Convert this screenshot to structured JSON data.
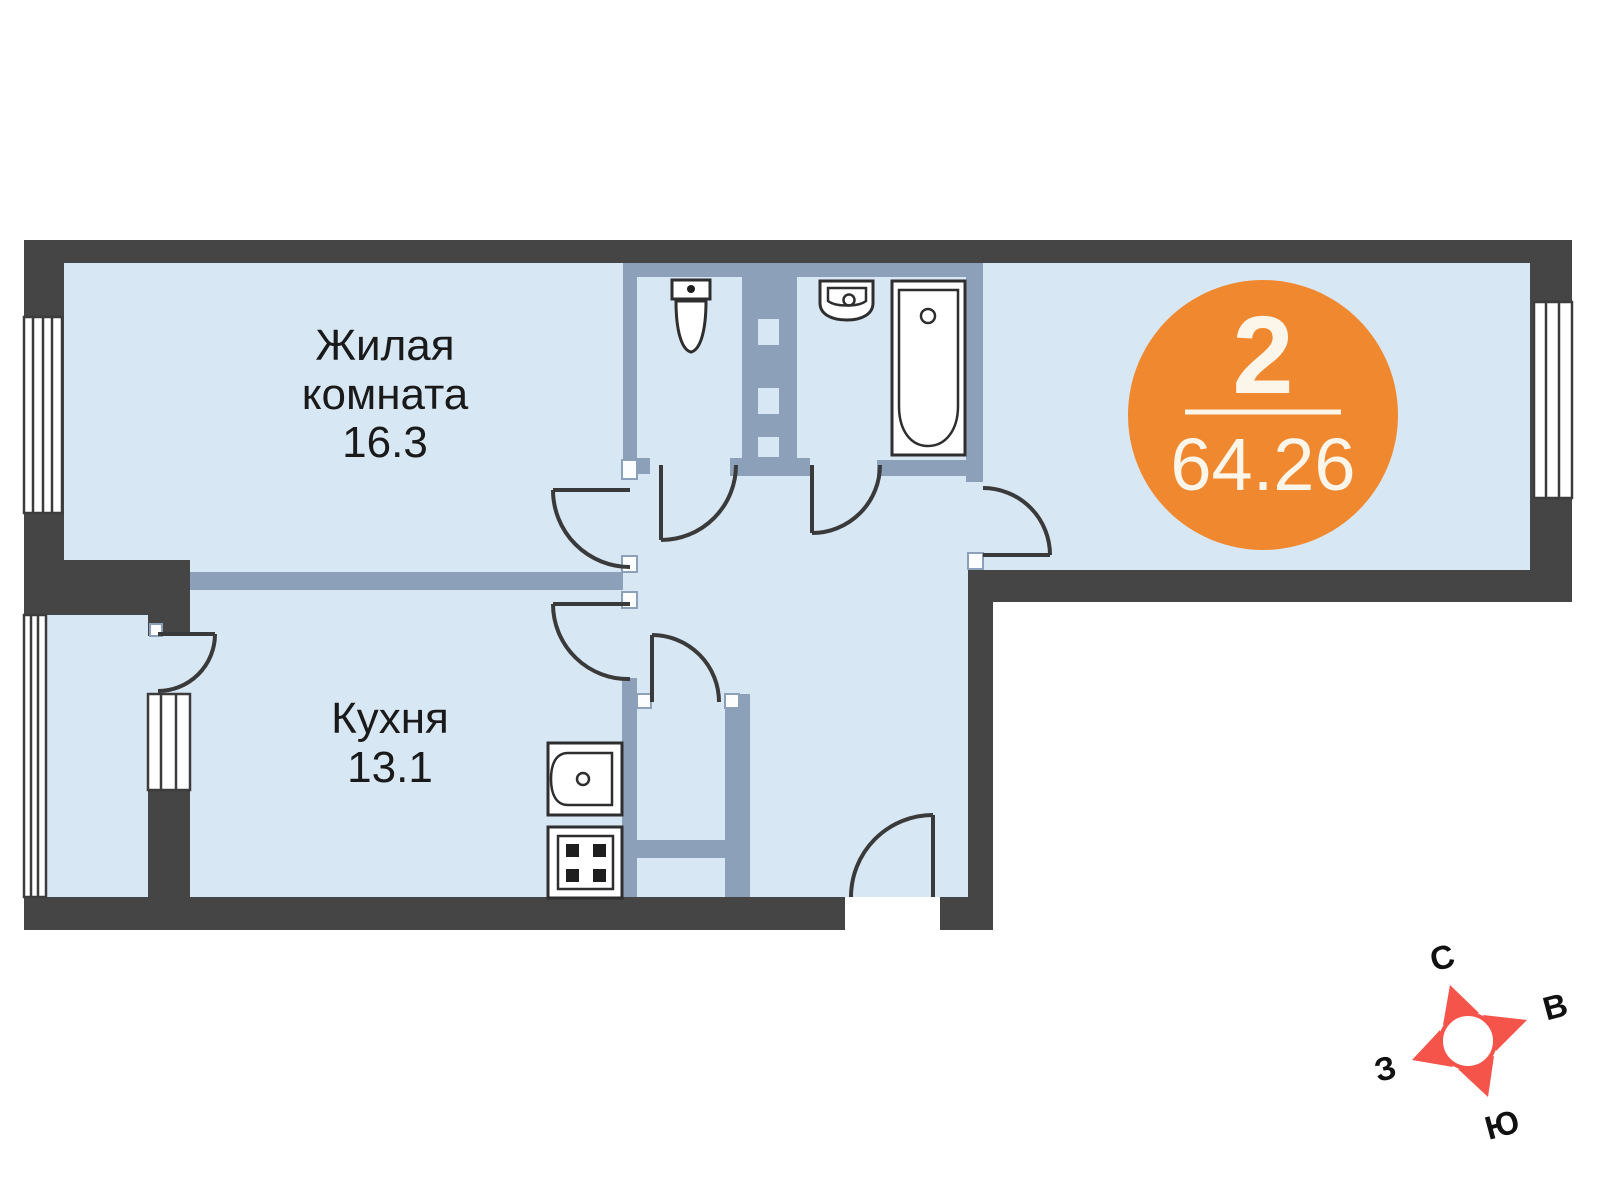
{
  "plan_type": "apartment-floor-plan",
  "rooms": [
    {
      "line1": "Жилая",
      "line2": "комната",
      "area": "16.3"
    },
    {
      "line1": "Кухня",
      "area": "13.1"
    }
  ],
  "badge": {
    "room_count": "2",
    "total_area": "64.26"
  },
  "compass": {
    "north": "С",
    "east": "В",
    "west": "З",
    "south": "Ю"
  },
  "colors": {
    "floor": "#D8E7F4",
    "outer_wall": "#454545",
    "inner_wall": "#8DA0BA",
    "door_line": "#3A3A3A",
    "badge": "#F0882F",
    "badge_text": "#FBF5EA",
    "compass": "#F4544A",
    "label_text": "#1A1A1A"
  }
}
